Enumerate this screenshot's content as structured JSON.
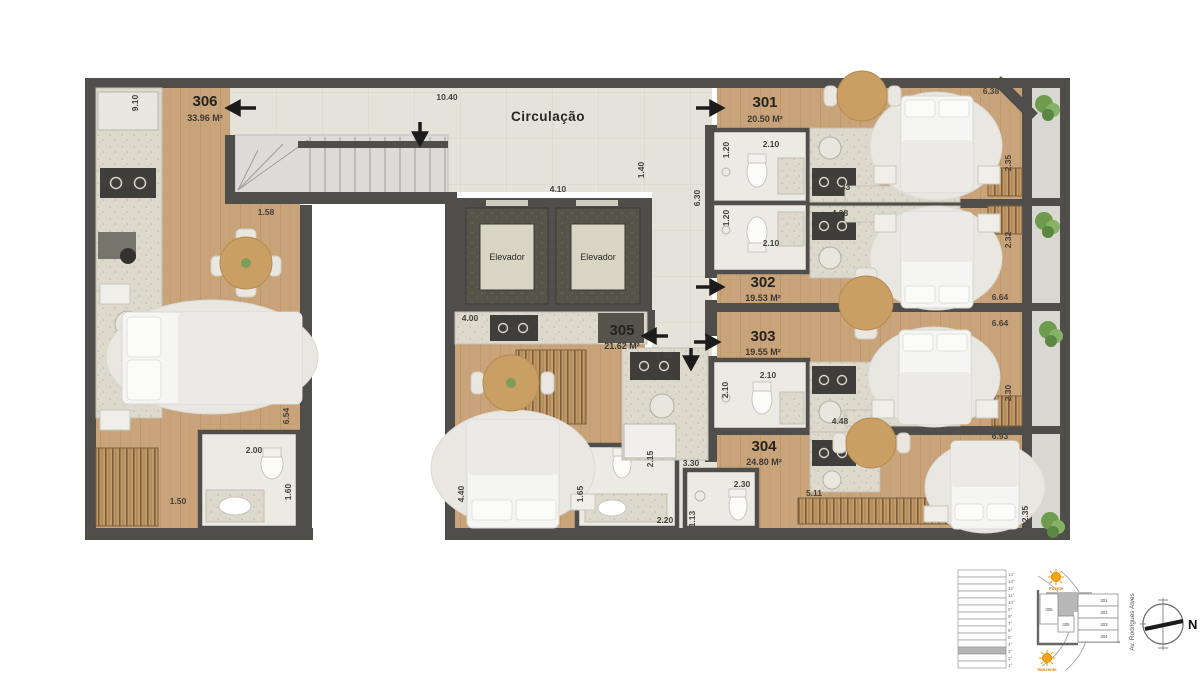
{
  "labels": {
    "circulation": "Circulação",
    "elevator_left": "Elevador",
    "elevator_right": "Elevador"
  },
  "units": {
    "u301": {
      "id": "301",
      "area": "20.50 M²"
    },
    "u302": {
      "id": "302",
      "area": "19.53 M²"
    },
    "u303": {
      "id": "303",
      "area": "19.55 M²"
    },
    "u304": {
      "id": "304",
      "area": "24.80 M²"
    },
    "u305": {
      "id": "305",
      "area": "21.62 M²"
    },
    "u306": {
      "id": "306",
      "area": "33.96 M²"
    }
  },
  "dims": {
    "corridor_top": "10.40",
    "k306_side": "9.10",
    "u306_entry": "1.58",
    "elev_hall": "4.10",
    "hall_w": "1.40",
    "u301_side": "6.30",
    "b301_w": "1.20",
    "b301_l": "2.10",
    "k301": "4.33",
    "balc301": "6.38",
    "u301_d": "2.35",
    "b302_w": "1.20",
    "b302_l": "2.10",
    "k302": "4.28",
    "u302_d": "2.32",
    "u302_len": "6.64",
    "u303_len": "6.64",
    "k305": "4.00",
    "u305_entry": "1.42",
    "b303_w": "2.10",
    "b303_l": "2.10",
    "k303": "4.48",
    "u303_d": "2.30",
    "u304_len": "6.93",
    "hall305": "2.15",
    "hall304": "3.30",
    "u305_bed": "4.40",
    "b305_w": "1.65",
    "b305_l": "2.20",
    "b304_l": "2.30",
    "b304_w": "1.13",
    "shelf304": "5.11",
    "u304_d": "2.35",
    "u306_len": "6.54",
    "b306_l": "2.00",
    "b306_w": "1.60",
    "shelf306": "1.50"
  },
  "legend": {
    "floors": [
      "14°",
      "13°",
      "12°",
      "11°",
      "10°",
      "9°",
      "8°",
      "7°",
      "6°",
      "5°",
      "4°",
      "3°",
      "2°",
      "1°"
    ],
    "highlighted_floor": "3°",
    "keyplan": {
      "u301": "301",
      "u302": "302",
      "u303": "303",
      "u304": "304",
      "u305": "305",
      "u306": "306"
    },
    "sun_top": "Poente",
    "sun_bottom": "Nascente",
    "street": "Av. Rodrigues Alves",
    "north": "N"
  },
  "colors": {
    "wall": "#4f4e4a",
    "wood": "#c9a379",
    "tile": "#e5e2da",
    "bath": "#eceae5",
    "balcony": "#d9d7d1",
    "sun_accent": "#e8940a"
  }
}
